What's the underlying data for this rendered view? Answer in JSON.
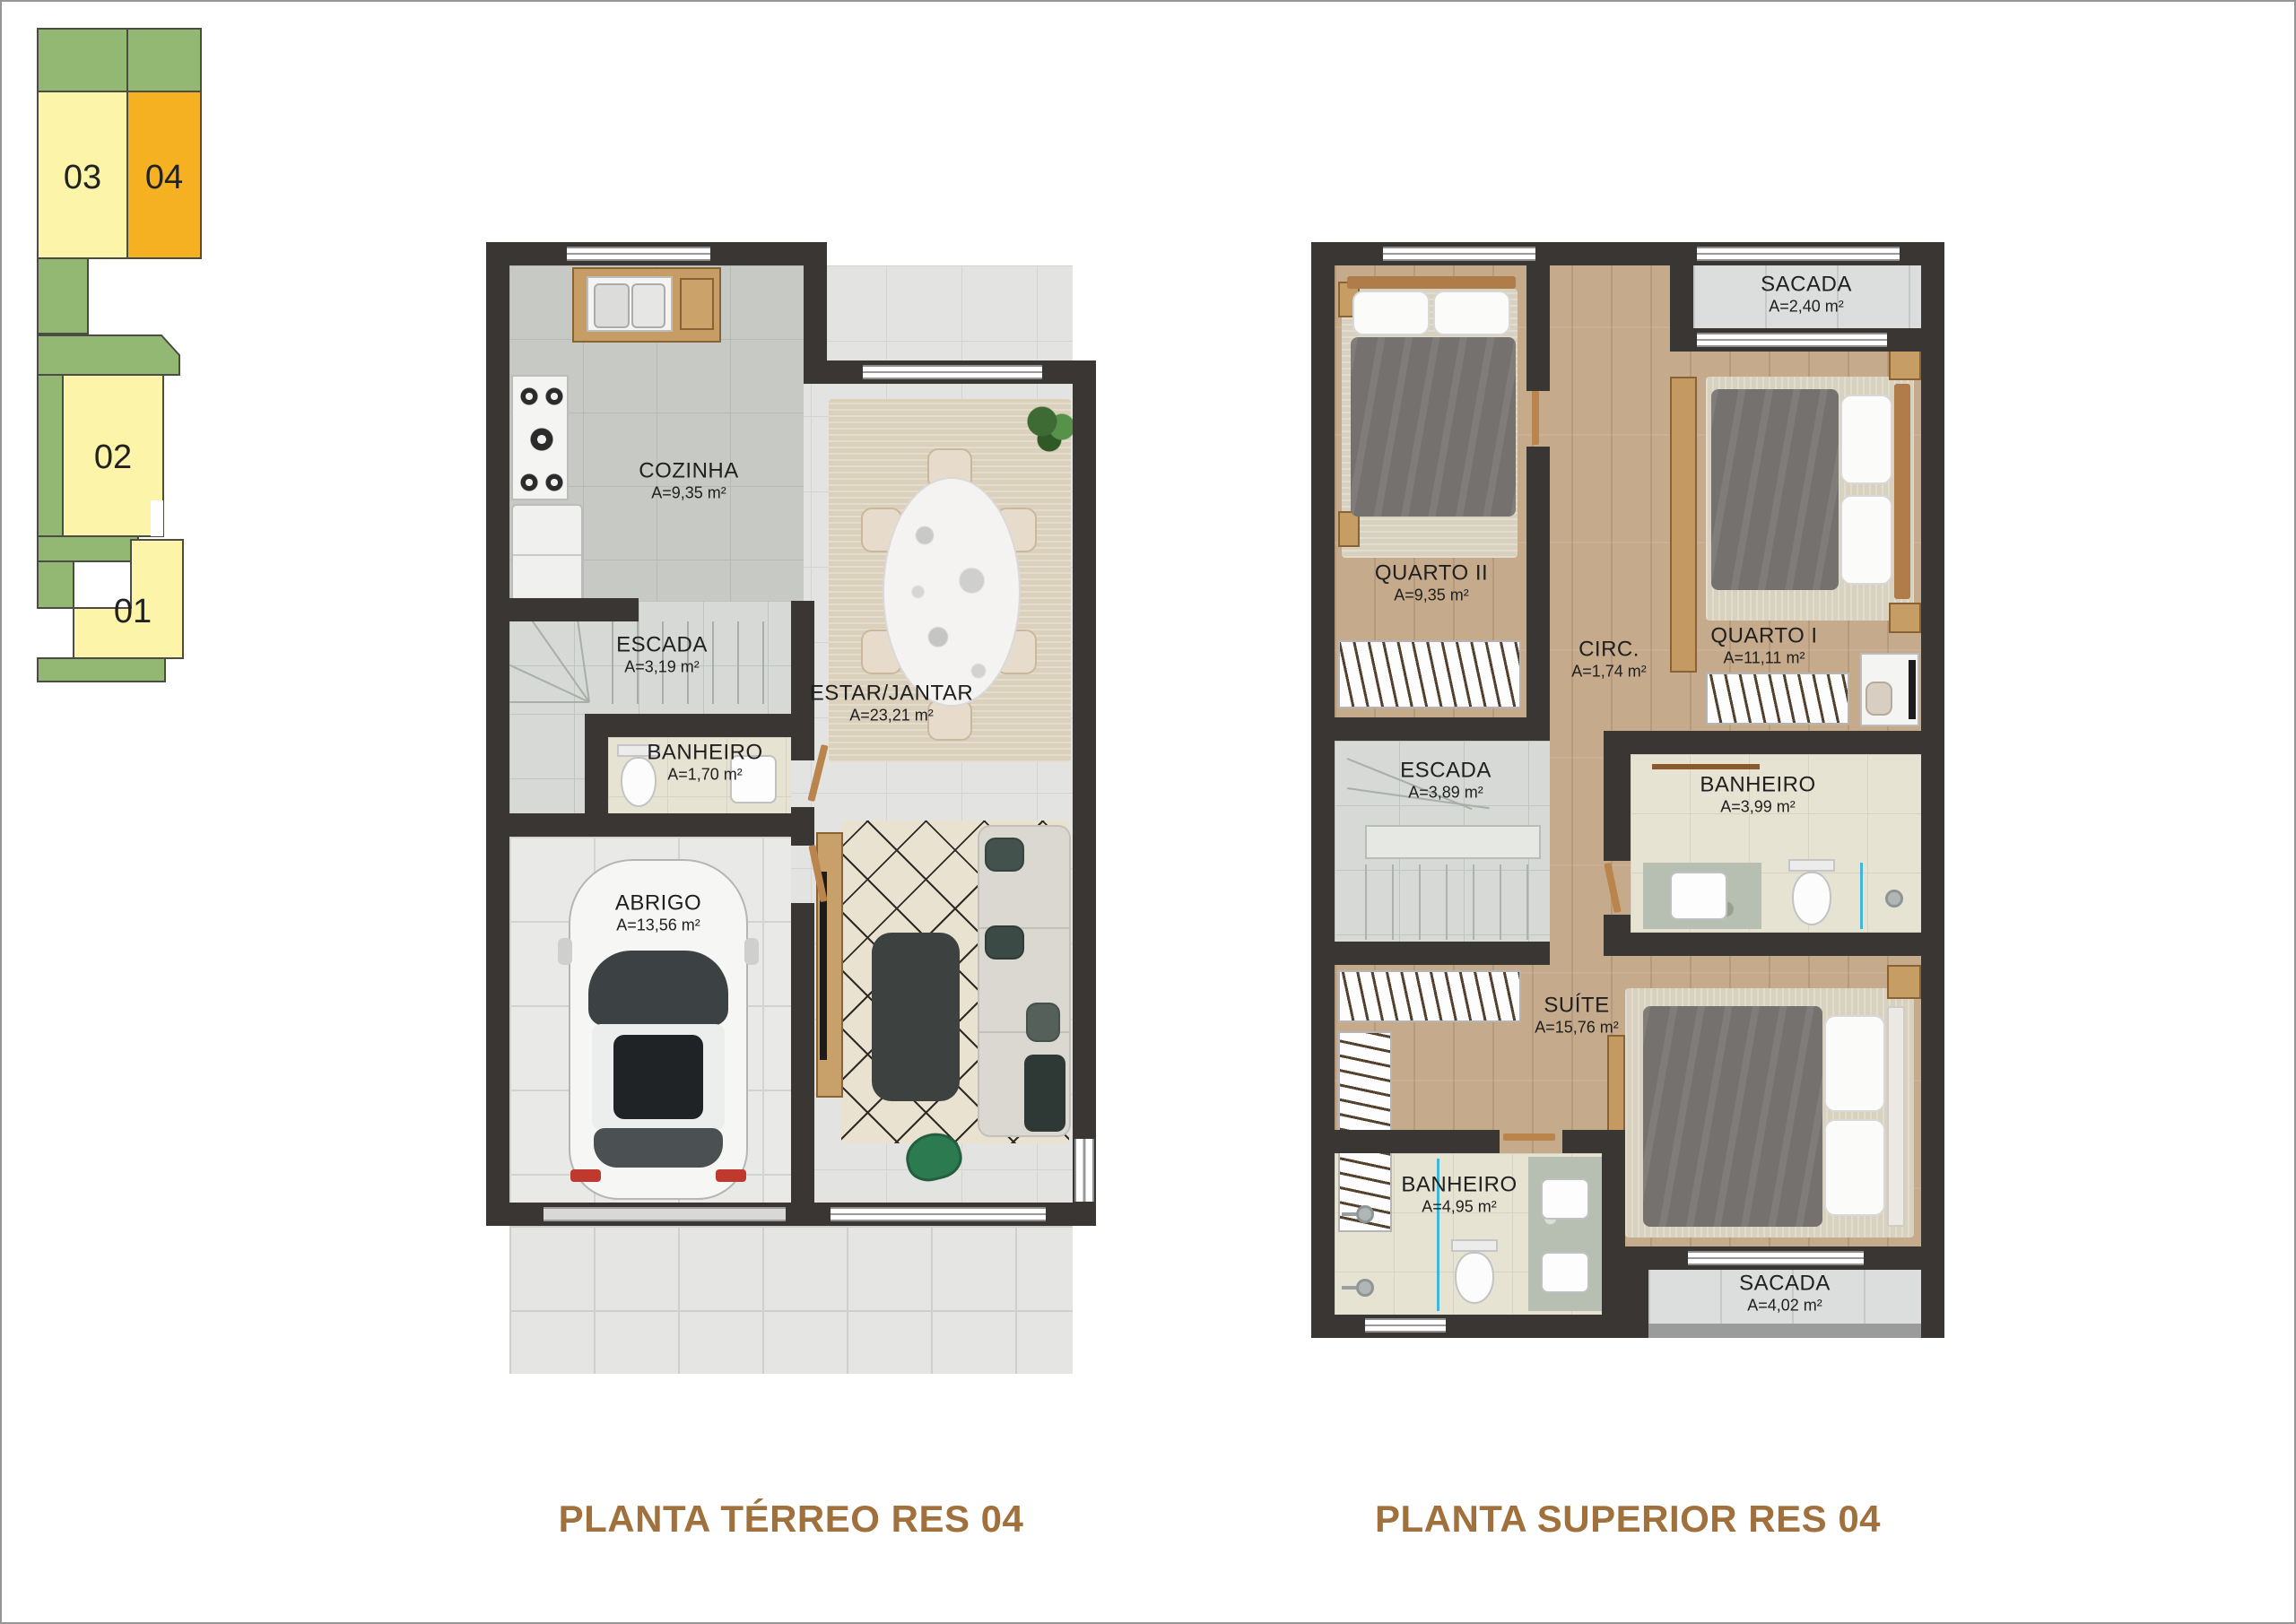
{
  "key_map": {
    "units": [
      {
        "label": "01",
        "highlighted": false
      },
      {
        "label": "02",
        "highlighted": false
      },
      {
        "label": "03",
        "highlighted": false
      },
      {
        "label": "04",
        "highlighted": true
      }
    ],
    "colors": {
      "green": "#92b873",
      "unit_normal": "#fbf4a9",
      "unit_highlight": "#f6b122"
    }
  },
  "ground_floor": {
    "title": "PLANTA TÉRREO RES 04",
    "rooms": [
      {
        "name": "COZINHA",
        "area": "A=9,35 m²"
      },
      {
        "name": "ESCADA",
        "area": "A=3,19 m²"
      },
      {
        "name": "BANHEIRO",
        "area": "A=1,70 m²"
      },
      {
        "name": "ESTAR/JANTAR",
        "area": "A=23,21 m²"
      },
      {
        "name": "ABRIGO",
        "area": "A=13,56 m²"
      }
    ]
  },
  "upper_floor": {
    "title": "PLANTA SUPERIOR RES 04",
    "rooms": [
      {
        "name": "SACADA",
        "area": "A=2,40 m²"
      },
      {
        "name": "QUARTO II",
        "area": "A=9,35 m²"
      },
      {
        "name": "QUARTO I",
        "area": "A=11,11 m²"
      },
      {
        "name": "CIRC.",
        "area": "A=1,74 m²"
      },
      {
        "name": "ESCADA",
        "area": "A=3,89 m²"
      },
      {
        "name": "BANHEIRO",
        "area": "A=3,99 m²"
      },
      {
        "name": "SUÍTE",
        "area": "A=15,76 m²"
      },
      {
        "name": "BANHEIRO",
        "area": "A=4,95 m²"
      },
      {
        "name": "SACADA",
        "area": "A=4,02 m²"
      }
    ]
  },
  "colors": {
    "title_brown": "#a1713d",
    "wall": "#3a3633"
  }
}
